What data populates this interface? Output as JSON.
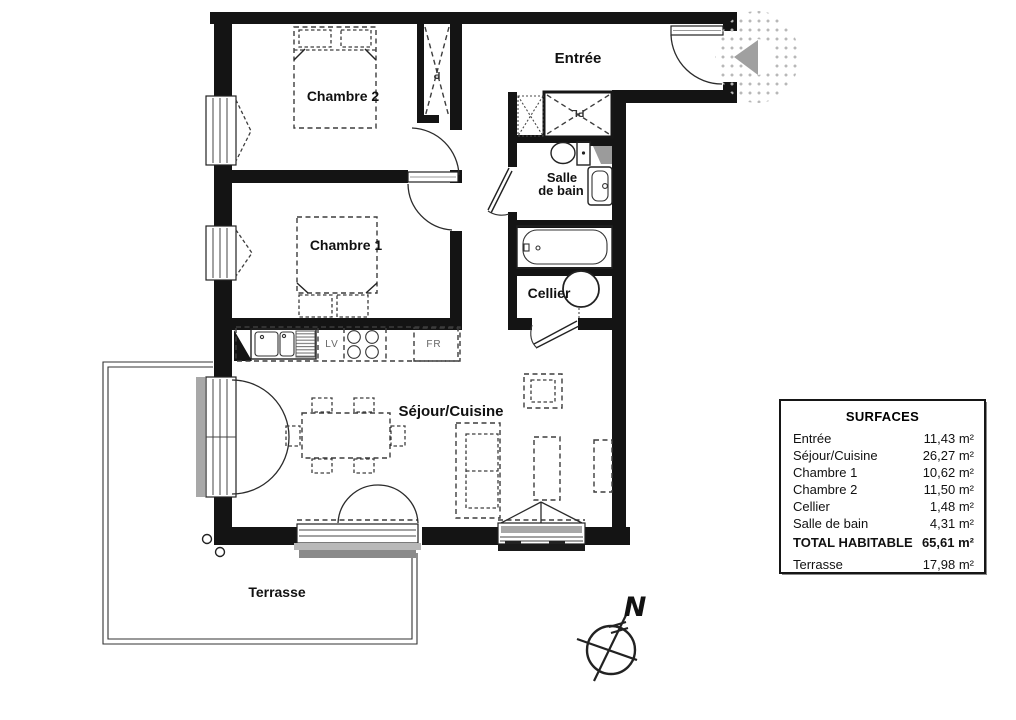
{
  "plan": {
    "labels": {
      "entree": "Entrée",
      "chambre2": "Chambre 2",
      "chambre1": "Chambre 1",
      "salle_line1": "Salle",
      "salle_line2": "de bain",
      "cellier": "Cellier",
      "sejour_cuisine": "Séjour/Cuisine",
      "terrasse": "Terrasse"
    },
    "fixture_labels": {
      "placard_p": "P",
      "placard_pl": "PL",
      "dishwasher": "LV",
      "fridge": "FR"
    },
    "compass_north": "N"
  },
  "surfaces_table": {
    "title": "SURFACES",
    "rows": [
      {
        "label": "Entrée",
        "value": "11,43 m²"
      },
      {
        "label": "Séjour/Cuisine",
        "value": "26,27 m²"
      },
      {
        "label": "Chambre 1",
        "value": "10,62 m²"
      },
      {
        "label": "Chambre 2",
        "value": "11,50 m²"
      },
      {
        "label": "Cellier",
        "value": "1,48 m²"
      },
      {
        "label": "Salle de bain",
        "value": "4,31 m²"
      }
    ],
    "total": {
      "label": "TOTAL HABITABLE",
      "value": "65,61 m²"
    },
    "terrace": {
      "label": "Terrasse",
      "value": "17,98 m²"
    }
  },
  "colors": {
    "wall": "#141414",
    "furniture_dash": "#3d3d3d",
    "entry_arrow": "#a0a0a0",
    "sill_light": "#b8b8b8",
    "sill_dark": "#8a8a8a"
  }
}
